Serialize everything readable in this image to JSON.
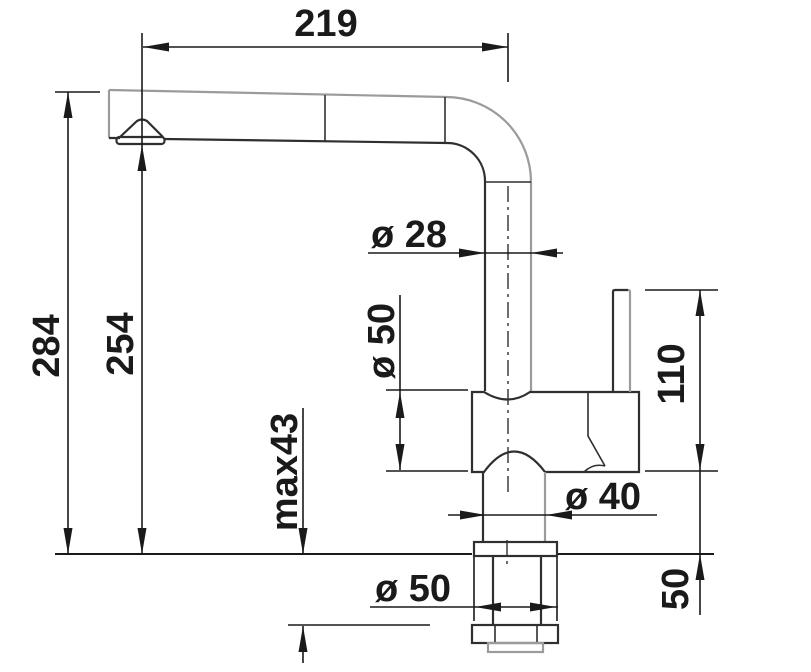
{
  "page": {
    "background": "#ffffff",
    "type": "technical-dimension-drawing",
    "subject": "kitchen-faucet-side-view"
  },
  "colors": {
    "dimension_lines": "#1a1a1a",
    "outline_dark": "#2f2f2f",
    "outline_light": "#9b9b9b"
  },
  "dimensions": {
    "spout_reach": "219",
    "total_height": "284",
    "spout_outlet_height": "254",
    "max_counter_thickness": "max43",
    "spout_pipe_diameter": "ø 28",
    "body_diameter": "ø 50",
    "lever_height": "110",
    "lower_body_diameter": "ø 40",
    "base_diameter": "ø 50",
    "under_counter_height": "50"
  }
}
